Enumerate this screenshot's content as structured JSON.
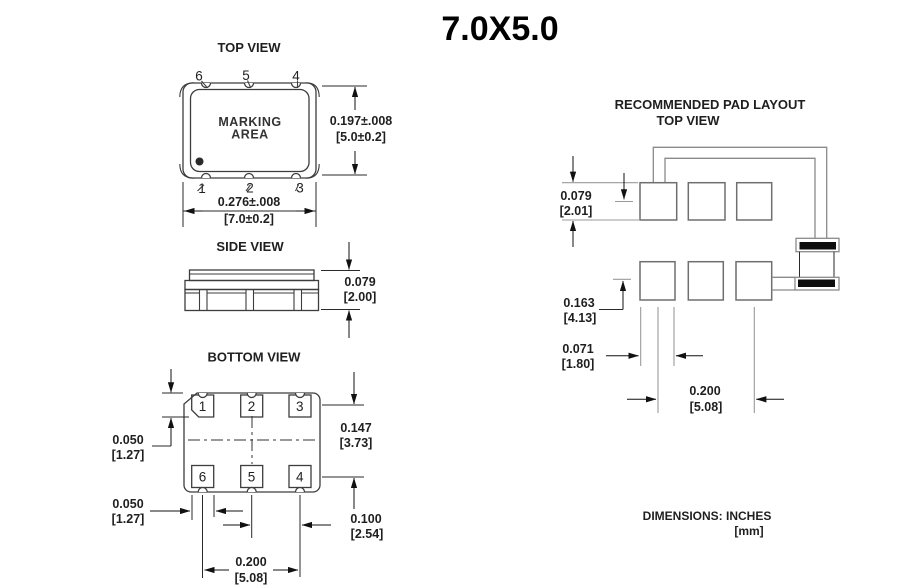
{
  "page_title": "7.0X5.0",
  "top_view": {
    "label": "TOP VIEW",
    "marking_line1": "MARKING",
    "marking_line2": "AREA",
    "pins": {
      "top_left": "6",
      "top_center": "5",
      "top_right": "4",
      "bottom_left": "1",
      "bottom_center": "2",
      "bottom_right": "3"
    },
    "dim_height_in": "0.197±.008",
    "dim_height_mm": "[5.0±0.2]",
    "dim_width_in": "0.276±.008",
    "dim_width_mm": "[7.0±0.2]"
  },
  "side_view": {
    "label": "SIDE VIEW",
    "dim_height_in": "0.079",
    "dim_height_mm": "[2.00]"
  },
  "bottom_view": {
    "label": "BOTTOM VIEW",
    "pads": {
      "p1": "1",
      "p2": "2",
      "p3": "3",
      "p6": "6",
      "p5": "5",
      "p4": "4"
    },
    "dim_pad_height_in": "0.050",
    "dim_pad_height_mm": "[1.27]",
    "dim_span_in": "0.147",
    "dim_span_mm": "[3.73]",
    "dim_pad_width_in": "0.050",
    "dim_pad_width_mm": "[1.27]",
    "dim_pitch_small_in": "0.100",
    "dim_pitch_small_mm": "[2.54]",
    "dim_pitch_large_in": "0.200",
    "dim_pitch_large_mm": "[5.08]"
  },
  "pad_layout": {
    "title": "RECOMMENDED PAD LAYOUT",
    "subtitle": "TOP VIEW",
    "dim_pad_height_in": "0.079",
    "dim_pad_height_mm": "[2.01]",
    "dim_row_pitch_in": "0.163",
    "dim_row_pitch_mm": "[4.13]",
    "dim_pad_width_in": "0.071",
    "dim_pad_width_mm": "[1.80]",
    "dim_pitch_in": "0.200",
    "dim_pitch_mm": "[5.08]"
  },
  "footer": {
    "units_line1": "DIMENSIONS: INCHES",
    "units_line2": "[mm]"
  }
}
